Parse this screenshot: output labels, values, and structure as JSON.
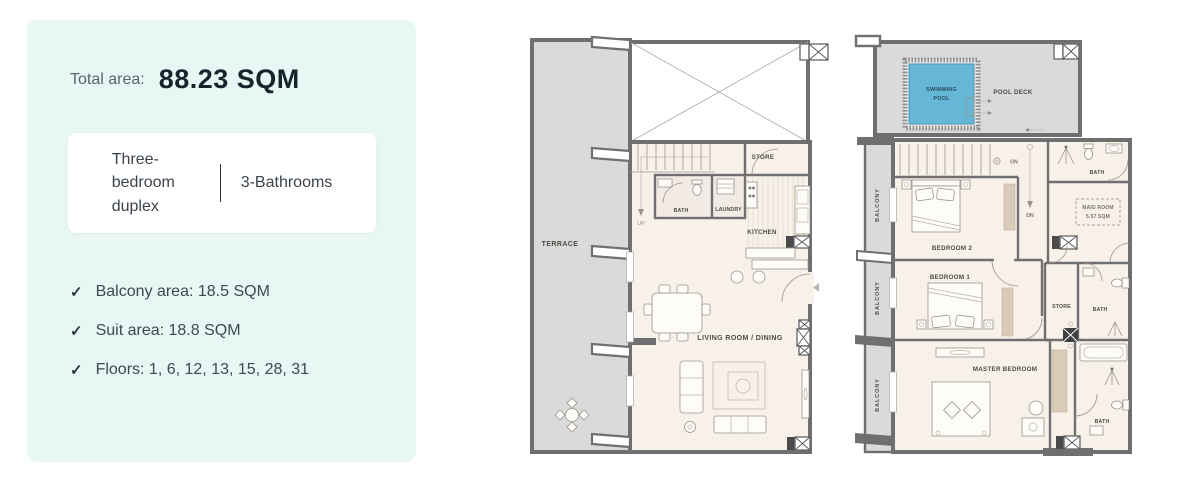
{
  "panel": {
    "total_area_label": "Total area:",
    "total_area_value": "88.23 SQM",
    "card": {
      "type_label": "Three-bedroom duplex",
      "bathrooms_label": "3-Bathrooms"
    },
    "check_icon": "✓",
    "features": [
      {
        "label": "Balcony area: 18.5 SQM"
      },
      {
        "label": "Suit area: 18.8 SQM"
      },
      {
        "label": "Floors: 1, 6, 12, 13, 15, 28, 31"
      }
    ]
  },
  "floorplans": {
    "lower": {
      "labels": {
        "terrace": "TERRACE",
        "store": "STORE",
        "bath": "BATH",
        "laundry": "LAUNDRY",
        "kitchen": "KITCHEN",
        "living": "LIVING ROOM / DINING",
        "up": "UP"
      }
    },
    "upper": {
      "labels": {
        "swimming_1": "SWIMMING",
        "swimming_2": "POOL",
        "pool_deck": "POOL DECK",
        "balcony": "BALCONY",
        "bath_top": "BATH",
        "maid_1": "MAID ROOM",
        "maid_2": "5.57 SQM",
        "bedroom2": "BEDROOM 2",
        "bedroom1": "BEDROOM 1",
        "store": "STORE",
        "bath_mid": "BATH",
        "master": "MASTER BEDROOM",
        "bath_bottom": "BATH",
        "on": "ON",
        "dn": "DN"
      }
    },
    "colors": {
      "panel_bg": "#e8f6f4",
      "value_text": "#18242c",
      "muted_text": "#54686c",
      "body_text": "#3d4a52",
      "wall": "#6f6f6f",
      "outdoor": "#dadada",
      "interior": "#f7f1e9",
      "pool": "#66b7d7",
      "plan_label": "#4e4b44",
      "wardrobe_tan": "#d9cbb8"
    }
  }
}
